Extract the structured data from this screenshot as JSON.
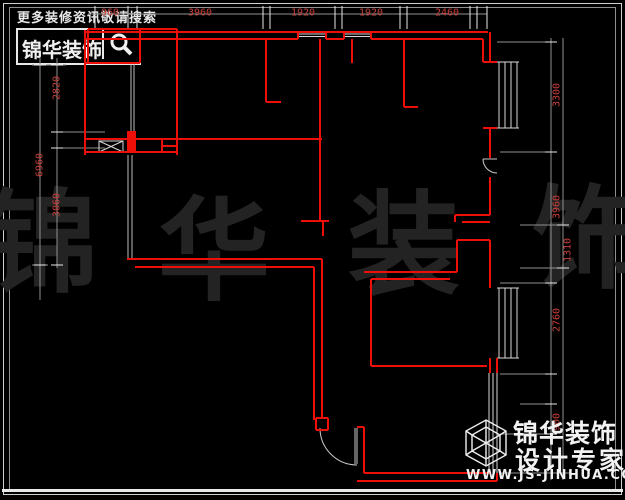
{
  "header": {
    "tagline": "更多装修资讯敬请搜索",
    "logo": {
      "brand": "锦华装饰",
      "icon": "magnifier-icon"
    }
  },
  "watermark": {
    "chars": [
      "锦",
      "华",
      "装",
      "饰"
    ]
  },
  "dimensions": {
    "unit": "mm",
    "top": [
      "960",
      "3960",
      "1920",
      "1920",
      "2460"
    ],
    "left_outer": [
      "6960"
    ],
    "left_inner": [
      "2820",
      "3060"
    ],
    "right_outer": [
      "3300",
      "3960",
      "2760",
      "900"
    ],
    "right_inner": [
      "1310"
    ]
  },
  "footer_logo": {
    "brand": "锦华装饰",
    "subtitle": "设计专家",
    "website": "WWW.JS-JINHUA.COM",
    "icon": "cube-hexagon-icon"
  },
  "colors": {
    "background": "#000000",
    "wall_red": "#ee1008",
    "dim_text_red": "#c8403a",
    "dim_line_gray": "#909090",
    "window_white": "#d8d8d8",
    "frame_white": "#cfcfcf",
    "watermark_gray": "#232323"
  }
}
